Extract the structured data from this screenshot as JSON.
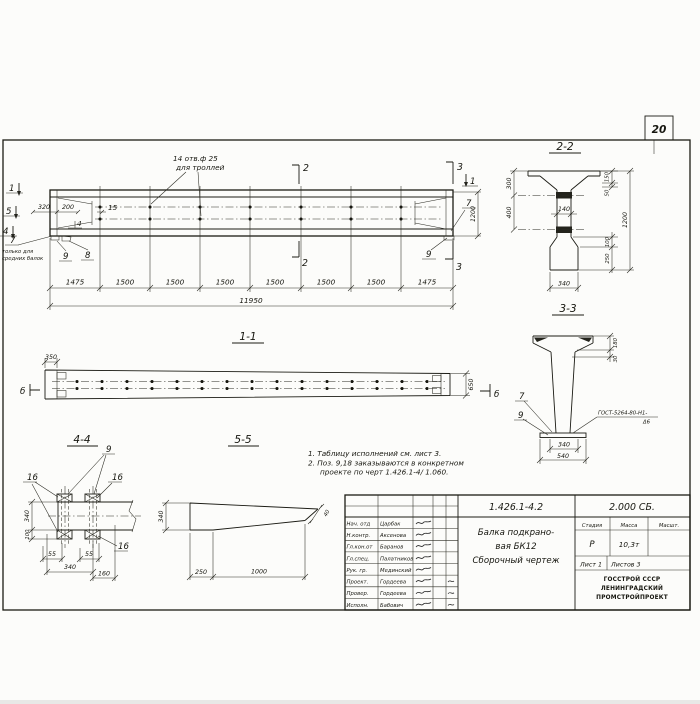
{
  "sheet": {
    "page_number": "20"
  },
  "elevation": {
    "holes_note_1": "14 отв.ф 25",
    "holes_note_2": "для троллей",
    "cut_left_1": "1",
    "cut_left_5": "5",
    "cut_left_4": "4",
    "cut_2_top": "2",
    "cut_2_bot": "2",
    "cut_3_top": "3",
    "cut_3_bot": "3",
    "cut_1_right": "1",
    "dim_320": "320",
    "dim_200": "200",
    "pos_15": "15",
    "cut_4_inner": "4",
    "pos_7_left": "7",
    "pos_7_note_1": "только для",
    "pos_7_note_2": "средних балок",
    "pos_9_left": "9",
    "pos_8": "8",
    "pos_7_right": "7",
    "pos_9_right": "9",
    "dim_height": "1200",
    "segments": [
      "1475",
      "1500",
      "1500",
      "1500",
      "1500",
      "1500",
      "1500",
      "1475"
    ],
    "dim_total": "11950"
  },
  "section22": {
    "title": "2-2",
    "dim_300": "300",
    "dim_400": "400",
    "dim_140": "140",
    "dim_150": "150",
    "dim_50": "50",
    "dim_1200": "1200",
    "dim_100": "100",
    "dim_250": "250",
    "dim_340": "340"
  },
  "section33": {
    "title": "3-3",
    "dim_180": "180",
    "dim_30": "30",
    "pos_7": "7",
    "pos_9": "9",
    "weld_line_1": "ГОСТ-5264-80-Н1-",
    "weld_line_2": "Δ6",
    "dim_340": "340",
    "dim_540": "540"
  },
  "section11": {
    "title": "1-1",
    "dim_350": "350",
    "dim_650": "650",
    "marker_left": "б",
    "marker_right": "б"
  },
  "section44": {
    "title": "4-4",
    "pos_9": "9",
    "pos_16_left": "16",
    "pos_16_right": "16",
    "pos_16_bottom": "16",
    "dim_340_left": "340",
    "dim_100": "100",
    "dim_55_a": "55",
    "dim_55_b": "55",
    "dim_340_bottom": "340",
    "dim_160": "160"
  },
  "section55": {
    "title": "5-5",
    "dim_340": "340",
    "dim_40": "40",
    "dim_250": "250",
    "dim_1000": "1000"
  },
  "notes": {
    "line_1": "1. Таблицу исполнений см. лист 3.",
    "line_2": "2. Поз. 9,18 заказываются в конкретном",
    "line_3": "проекте по черт 1.426.1-4/ 1.060."
  },
  "titleblock": {
    "designation": "1.426.1-4.2",
    "doc_code": "2.000 СБ.",
    "title_line_1": "Балка подкрано-",
    "title_line_2": "вая БК12",
    "title_line_3": "Сборочный чертеж",
    "col_stage": "Стадия",
    "col_mass": "Масса",
    "col_scale": "Масшт.",
    "stage": "Р",
    "mass": "10,3т",
    "sheet_no": "Лист 1",
    "sheets_total": "Листов 3",
    "org_line_1": "ГОССТРОЙ СССР",
    "org_line_2": "ЛЕНИНГРАДСКИЙ",
    "org_line_3": "ПРОМСТРОЙПРОЕКТ",
    "signatures": [
      {
        "role": "Нач. отд",
        "name": "Царбак"
      },
      {
        "role": "Н.контр.",
        "name": "Аксенова"
      },
      {
        "role": "Гл.кон.от",
        "name": "Баранов"
      },
      {
        "role": "Гл.спец.",
        "name": "Палатников"
      },
      {
        "role": "Рук. гр.",
        "name": "Мединский"
      },
      {
        "role": "Проект.",
        "name": "Гордеева"
      },
      {
        "role": "Провер.",
        "name": "Гордеева"
      },
      {
        "role": "Исполн.",
        "name": "Бабович"
      }
    ]
  }
}
